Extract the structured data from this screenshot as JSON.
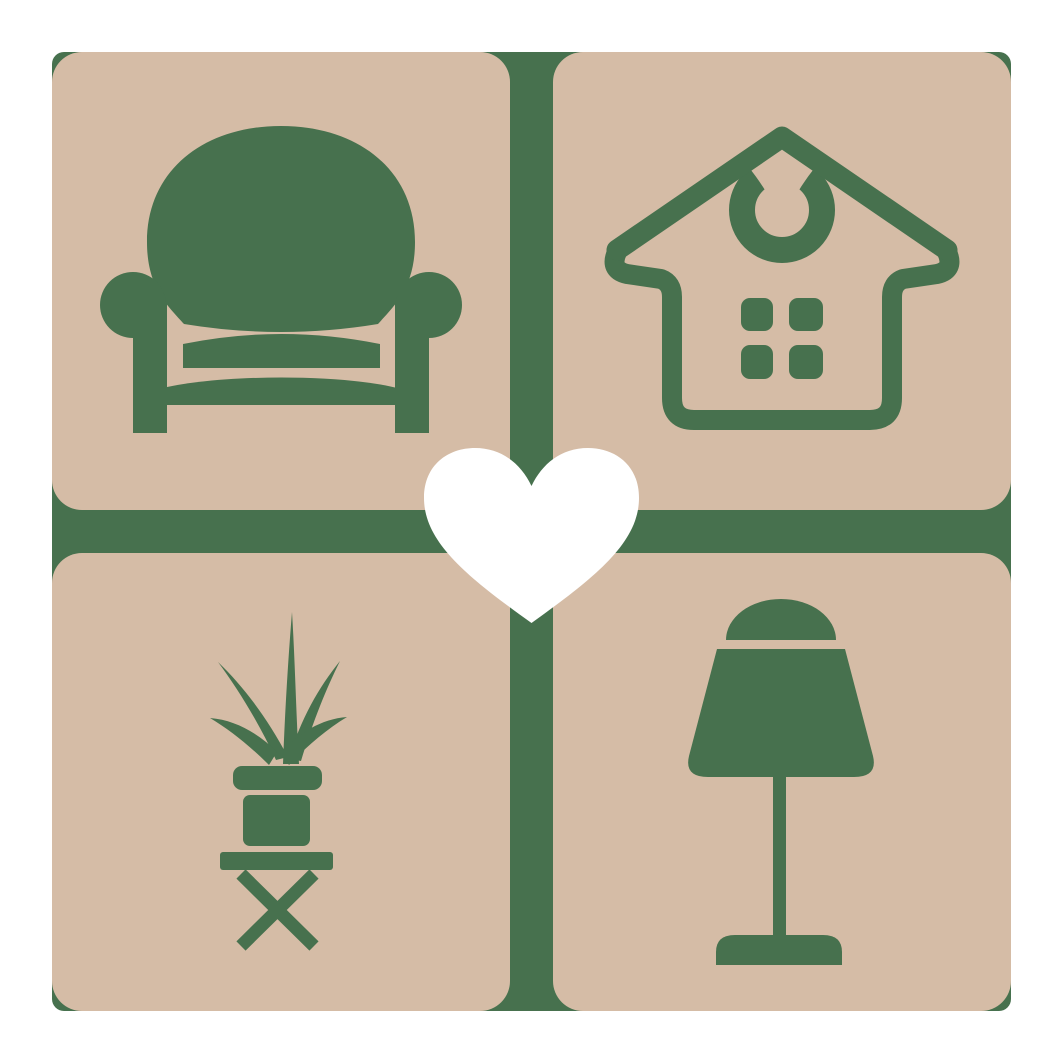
{
  "logo": {
    "colors": {
      "green": "#47714E",
      "tan": "#D5BCA6",
      "white": "#FFFFFF"
    },
    "tiles": [
      {
        "icon": "armchair-icon",
        "label": "armchair",
        "position": "top-left"
      },
      {
        "icon": "house-icon",
        "label": "house",
        "position": "top-right"
      },
      {
        "icon": "potted-plant-icon",
        "label": "potted plant",
        "position": "bottom-left"
      },
      {
        "icon": "table-lamp-icon",
        "label": "table lamp",
        "position": "bottom-right"
      }
    ],
    "center_icon": {
      "icon": "heart-icon",
      "label": "heart"
    }
  }
}
